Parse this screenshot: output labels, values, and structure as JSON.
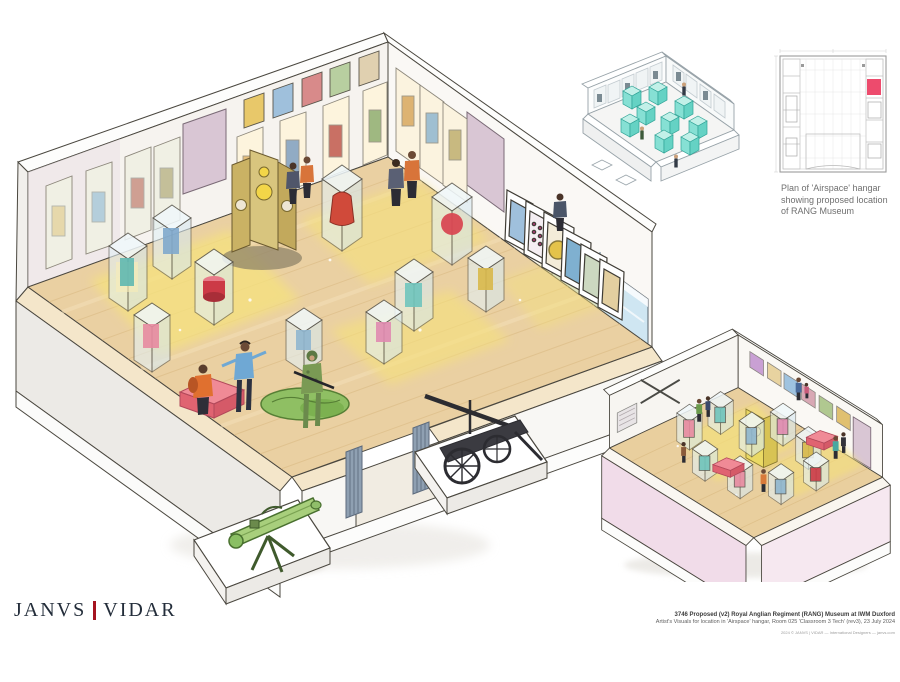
{
  "logo": {
    "janvs": "JANVS",
    "separator": "|",
    "vidar": "VIDAR"
  },
  "plan": {
    "caption_lines": {
      "0": "Plan of 'Airspace' hangar",
      "1": "showing proposed location",
      "2": "of RANG Museum"
    }
  },
  "caption": {
    "title": "3746 Proposed (v2) Royal Anglian Regiment (RANG) Museum at IWM Duxford",
    "subtitle": "Artist's Visuals for location in 'Airspace' hangar, Room 025 'Classroom 3 Tech' (rev3), 23 July 2024",
    "credit": "2024 © JANVS | VIDAR — International Designers — janvs.com"
  },
  "palette": {
    "logo_text": "#232d3a",
    "logo_separator_red": "#a51420",
    "plan_highlight_pink": "#ed4b6d",
    "plan_linework_gray": "#c0c0c0",
    "caption_gray": "#6f6f6f",
    "wood_floor_tan": "#e9cf9e",
    "spotlight_yellow": "#f5e17c",
    "sketch_case_teal": "#7fd8cc",
    "exterior_wall_pink": "#f0dbe7",
    "bench_pink": "#ef8a96",
    "door_mauve": "#d9c6d4",
    "artifact_red": "#d0453f",
    "camo_green": "#7a9a54",
    "launcher_green": "#a8cf7c",
    "window_blue": "#cfe6f2"
  }
}
